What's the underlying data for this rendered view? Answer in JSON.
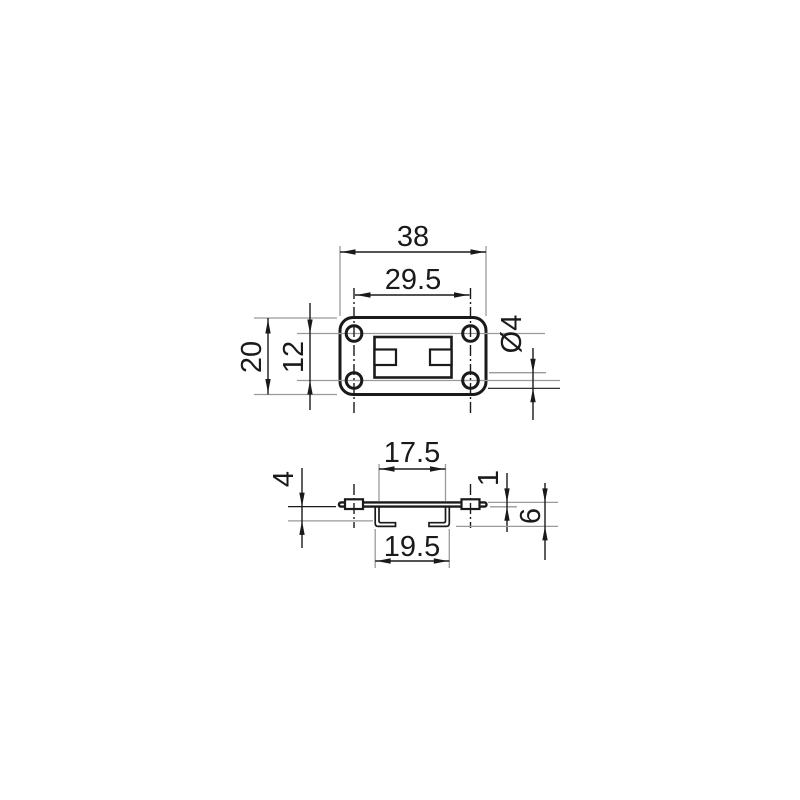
{
  "drawing": {
    "type": "technical-dimension-drawing",
    "part": "mounting-plate-with-bent-hooks",
    "colors": {
      "background": "#ffffff",
      "object_line": "#1a1a1a",
      "dimension_line": "#1a1a1a",
      "extension_line": "#9a9a9a"
    },
    "top_view": {
      "dim_overall_width": "38",
      "dim_hole_spacing_horizontal": "29.5",
      "dim_overall_height": "20",
      "dim_hole_spacing_vertical": "12",
      "dim_hole_diameter": "Ø4"
    },
    "side_view": {
      "dim_tab_inner_spacing": "17.5",
      "dim_tab_outer_spacing": "19.5",
      "dim_hook_inner_depth": "4",
      "dim_plate_thickness": "1",
      "dim_overall_depth": "6"
    }
  }
}
